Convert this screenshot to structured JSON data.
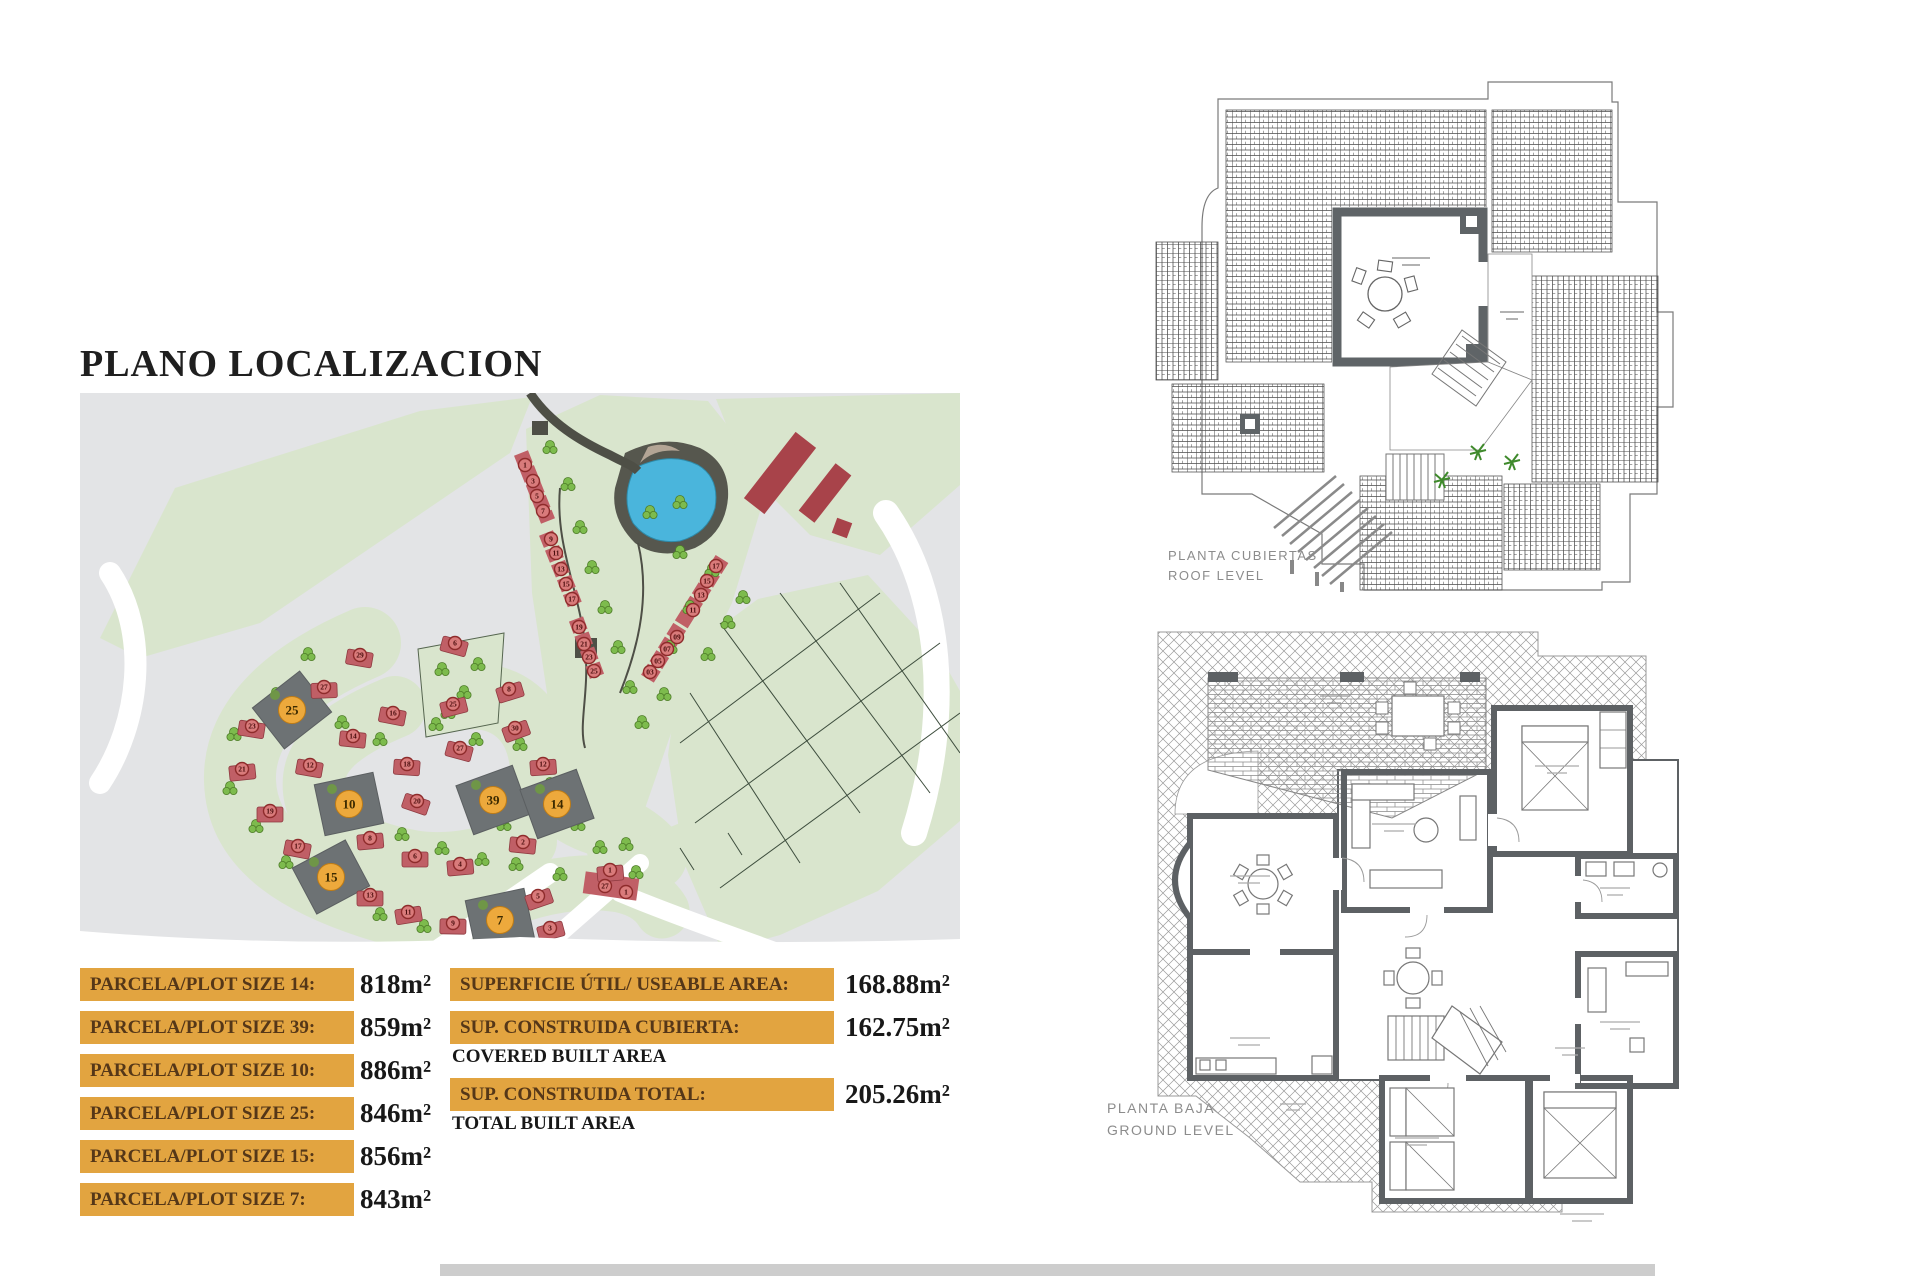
{
  "title": "PLANO LOCALIZACION",
  "plot_table": {
    "unit": "m²",
    "rows": [
      {
        "label": "PARCELA/PLOT SIZE 14:",
        "value": "818"
      },
      {
        "label": "PARCELA/PLOT SIZE 39:",
        "value": "859"
      },
      {
        "label": "PARCELA/PLOT SIZE 10:",
        "value": "886"
      },
      {
        "label": "PARCELA/PLOT SIZE 25:",
        "value": "846"
      },
      {
        "label": "PARCELA/PLOT SIZE 15:",
        "value": "856"
      },
      {
        "label": "PARCELA/PLOT SIZE 7:",
        "value": "843"
      }
    ]
  },
  "area_table": {
    "unit": "m²",
    "rows": [
      {
        "label": "SUPERFICIE ÚTIL/ USEABLE AREA:",
        "value": "168.88",
        "sub": ""
      },
      {
        "label": "SUP. CONSTRUIDA CUBIERTA:",
        "value": "162.75",
        "sub": "COVERED BUILT AREA"
      },
      {
        "label": "SUP. CONSTRUIDA TOTAL:",
        "value": "205.26",
        "sub": "TOTAL BUILT AREA"
      }
    ]
  },
  "plans": {
    "roof": {
      "line1": "PLANTA CUBIERTAS",
      "line2": "ROOF LEVEL"
    },
    "ground": {
      "line1": "PLANTA BAJA",
      "line2": "GROUND LEVEL"
    }
  },
  "site_map": {
    "colors": {
      "bg": "#e3e4e6",
      "land": "#d9e5cd",
      "road": "#ffffff",
      "house": "#c05f66",
      "house_dark": "#a8434a",
      "plot": "#6d7274",
      "accent": "#eda93c",
      "marker_fill": "#d97b7b",
      "marker_stroke": "#8e2b2b",
      "pond": "#4ab5dc",
      "tree": "#7dbb4d"
    },
    "highlighted_plots": [
      {
        "n": "25",
        "x": 212,
        "y": 317,
        "r": -38
      },
      {
        "n": "10",
        "x": 269,
        "y": 411,
        "r": -12
      },
      {
        "n": "15",
        "x": 251,
        "y": 484,
        "r": -28
      },
      {
        "n": "7",
        "x": 420,
        "y": 527,
        "r": -12
      },
      {
        "n": "39",
        "x": 413,
        "y": 407,
        "r": -20
      },
      {
        "n": "14",
        "x": 477,
        "y": 411,
        "r": -20
      }
    ],
    "red_markers": [
      {
        "n": "29",
        "x": 280,
        "y": 262
      },
      {
        "n": "27",
        "x": 244,
        "y": 294
      },
      {
        "n": "23",
        "x": 172,
        "y": 333
      },
      {
        "n": "21",
        "x": 162,
        "y": 376
      },
      {
        "n": "19",
        "x": 190,
        "y": 418
      },
      {
        "n": "17",
        "x": 218,
        "y": 453
      },
      {
        "n": "13",
        "x": 290,
        "y": 502
      },
      {
        "n": "11",
        "x": 328,
        "y": 519
      },
      {
        "n": "9",
        "x": 373,
        "y": 530
      },
      {
        "n": "16",
        "x": 313,
        "y": 320
      },
      {
        "n": "14",
        "x": 273,
        "y": 343
      },
      {
        "n": "12",
        "x": 230,
        "y": 372
      },
      {
        "n": "18",
        "x": 327,
        "y": 371
      },
      {
        "n": "20",
        "x": 337,
        "y": 408
      },
      {
        "n": "8",
        "x": 290,
        "y": 445
      },
      {
        "n": "6",
        "x": 335,
        "y": 463
      },
      {
        "n": "4",
        "x": 380,
        "y": 471
      },
      {
        "n": "2",
        "x": 443,
        "y": 449
      },
      {
        "n": "6",
        "x": 375,
        "y": 250
      },
      {
        "n": "25",
        "x": 373,
        "y": 311
      },
      {
        "n": "8",
        "x": 429,
        "y": 296
      },
      {
        "n": "30",
        "x": 435,
        "y": 335
      },
      {
        "n": "27",
        "x": 380,
        "y": 355
      },
      {
        "n": "12",
        "x": 463,
        "y": 371
      },
      {
        "n": "5",
        "x": 458,
        "y": 503
      },
      {
        "n": "3",
        "x": 470,
        "y": 535
      },
      {
        "n": "1",
        "x": 530,
        "y": 477
      },
      {
        "n": "1",
        "x": 445,
        "y": 72,
        "h": 0
      },
      {
        "n": "3",
        "x": 453,
        "y": 88,
        "h": 0
      },
      {
        "n": "5",
        "x": 457,
        "y": 103,
        "h": 0
      },
      {
        "n": "7",
        "x": 463,
        "y": 118,
        "h": 0
      },
      {
        "n": "9",
        "x": 471,
        "y": 146,
        "h": 0
      },
      {
        "n": "11",
        "x": 476,
        "y": 160,
        "h": 0
      },
      {
        "n": "13",
        "x": 481,
        "y": 176,
        "h": 0
      },
      {
        "n": "15",
        "x": 486,
        "y": 191,
        "h": 0
      },
      {
        "n": "17",
        "x": 492,
        "y": 206,
        "h": 0
      },
      {
        "n": "19",
        "x": 499,
        "y": 234,
        "h": 0
      },
      {
        "n": "21",
        "x": 504,
        "y": 251,
        "h": 0
      },
      {
        "n": "23",
        "x": 509,
        "y": 264,
        "h": 0
      },
      {
        "n": "25",
        "x": 514,
        "y": 278,
        "h": 0
      },
      {
        "n": "27",
        "x": 525,
        "y": 493,
        "h": 0
      },
      {
        "n": "1",
        "x": 546,
        "y": 499,
        "h": 0
      },
      {
        "n": "17",
        "x": 636,
        "y": 173,
        "h": 0
      },
      {
        "n": "15",
        "x": 627,
        "y": 188,
        "h": 0
      },
      {
        "n": "13",
        "x": 621,
        "y": 202,
        "h": 0
      },
      {
        "n": "11",
        "x": 613,
        "y": 217,
        "h": 0
      },
      {
        "n": "09",
        "x": 597,
        "y": 244,
        "h": 0
      },
      {
        "n": "07",
        "x": 587,
        "y": 256,
        "h": 0
      },
      {
        "n": "05",
        "x": 578,
        "y": 268,
        "h": 0
      },
      {
        "n": "03",
        "x": 570,
        "y": 279,
        "h": 0
      }
    ],
    "trees": [
      [
        228,
        262
      ],
      [
        196,
        302
      ],
      [
        154,
        342
      ],
      [
        150,
        396
      ],
      [
        176,
        434
      ],
      [
        206,
        470
      ],
      [
        242,
        497
      ],
      [
        300,
        522
      ],
      [
        344,
        534
      ],
      [
        262,
        330
      ],
      [
        300,
        347
      ],
      [
        252,
        396
      ],
      [
        286,
        422
      ],
      [
        322,
        442
      ],
      [
        362,
        456
      ],
      [
        402,
        467
      ],
      [
        424,
        432
      ],
      [
        356,
        332
      ],
      [
        396,
        347
      ],
      [
        440,
        352
      ],
      [
        470,
        392
      ],
      [
        498,
        432
      ],
      [
        436,
        472
      ],
      [
        480,
        482
      ],
      [
        520,
        455
      ],
      [
        556,
        480
      ],
      [
        362,
        277
      ],
      [
        384,
        300
      ],
      [
        398,
        272
      ],
      [
        368,
        320
      ],
      [
        470,
        55
      ],
      [
        488,
        92
      ],
      [
        500,
        135
      ],
      [
        512,
        175
      ],
      [
        525,
        215
      ],
      [
        538,
        255
      ],
      [
        550,
        295
      ],
      [
        562,
        330
      ],
      [
        600,
        160
      ],
      [
        632,
        178
      ],
      [
        610,
        215
      ],
      [
        648,
        230
      ],
      [
        590,
        255
      ],
      [
        628,
        262
      ],
      [
        663,
        205
      ],
      [
        600,
        110
      ],
      [
        570,
        120
      ],
      [
        584,
        302
      ],
      [
        546,
        452
      ]
    ]
  }
}
